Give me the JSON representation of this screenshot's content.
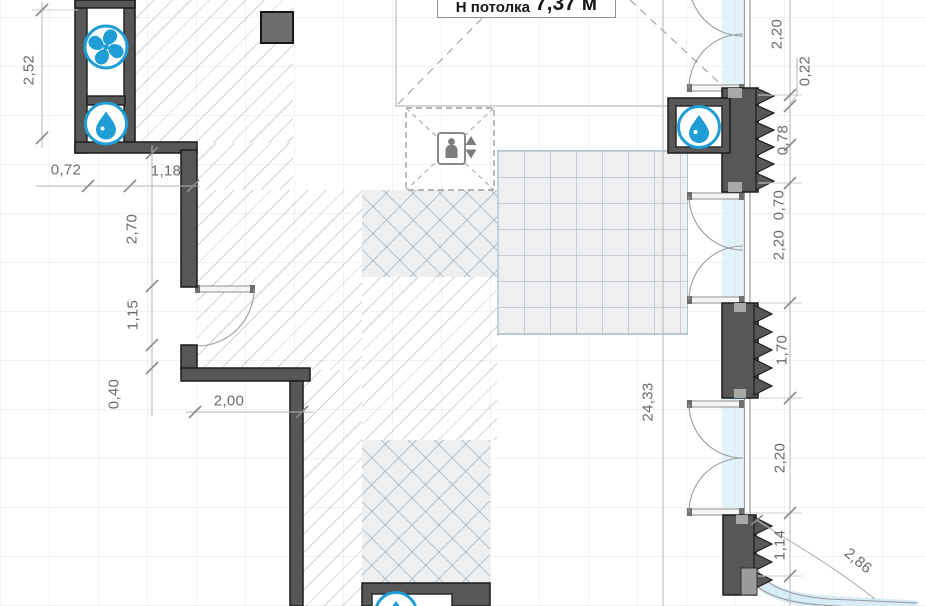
{
  "title_box": {
    "prefix": "Н потолка",
    "value": "7,37 м"
  },
  "dims": {
    "d252": "2,52",
    "d072": "0,72",
    "d118": "1,18",
    "d270": "2,70",
    "d115": "1,15",
    "d040": "0,40",
    "d200": "2,00",
    "d2433": "24,33",
    "r220a": "2,20",
    "r022": "0,22",
    "r078": "0,78",
    "r070": "0,70",
    "r220b": "2,20",
    "r170": "1,70",
    "r220c": "2,20",
    "r114": "1,14",
    "r286": "2,86"
  },
  "icons": {
    "fan": "fan-icon",
    "water_drop": "water-drop-icon",
    "elevator": "elevator-icon"
  },
  "colors": {
    "accent_blue": "#1f9ed6",
    "wall": "#575757",
    "glass": "#d6ecf7",
    "dim_text": "#6b6b6b"
  }
}
